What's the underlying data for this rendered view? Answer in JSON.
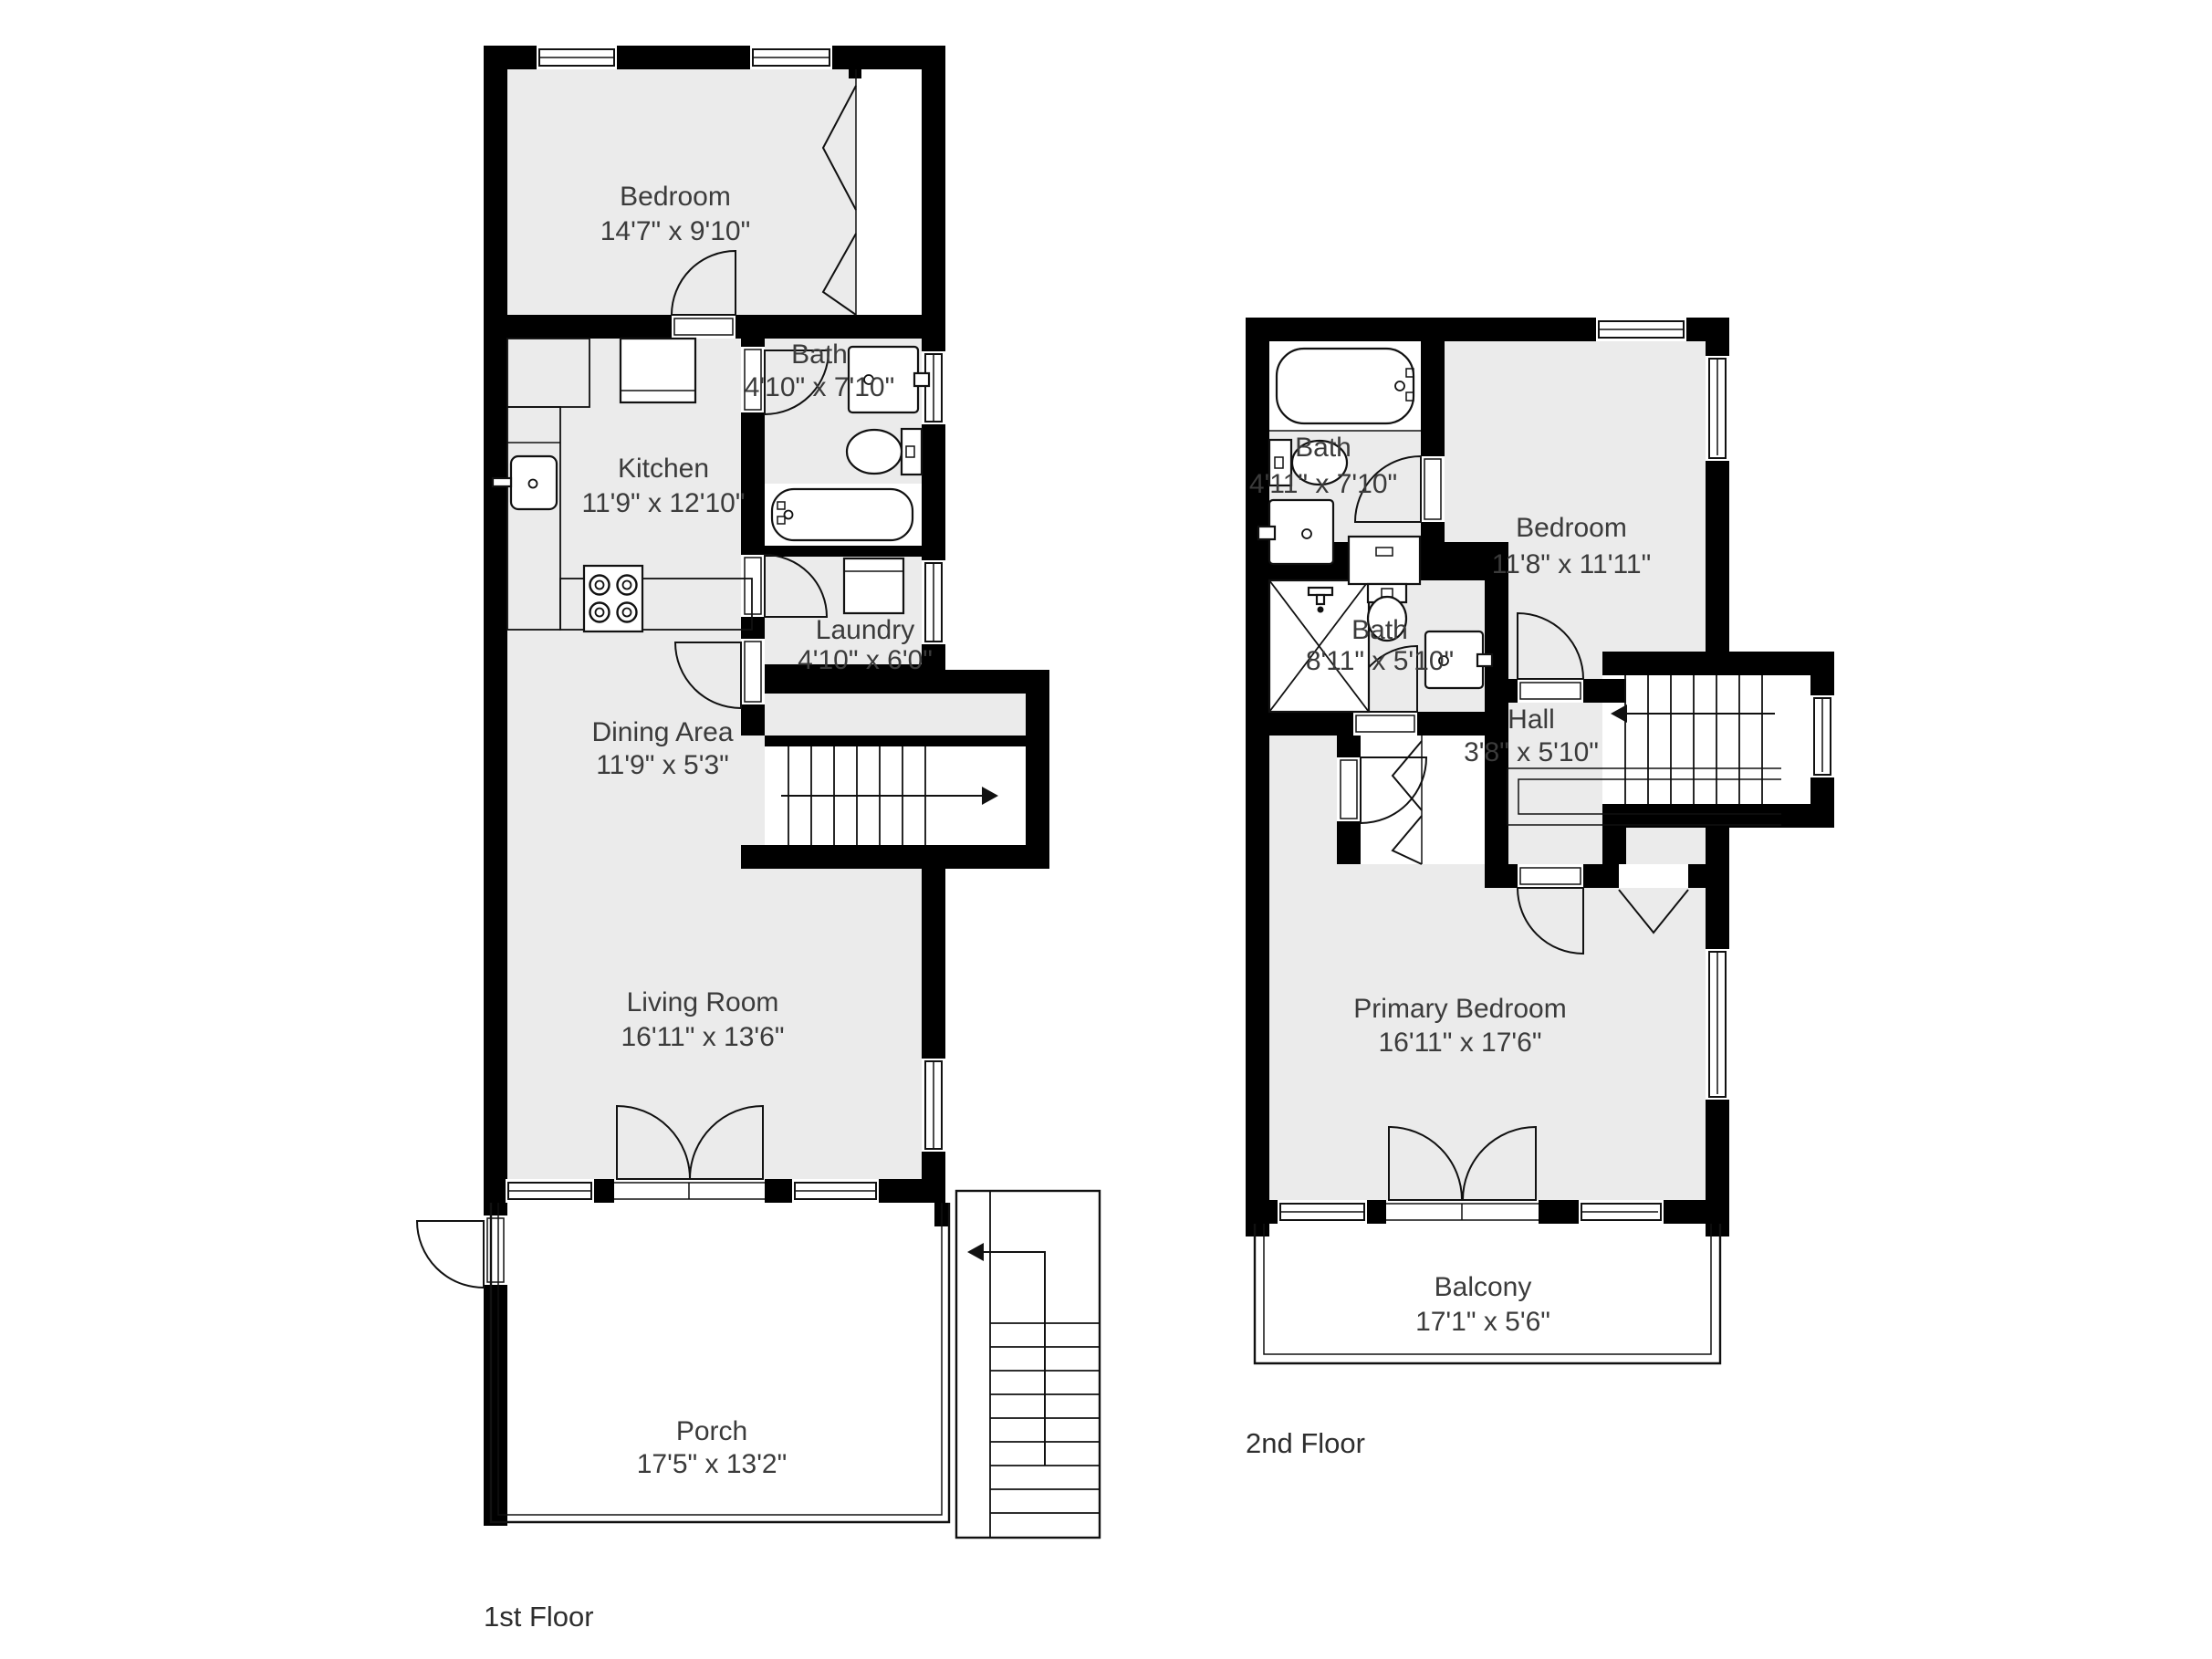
{
  "title": "Two-story floor plan",
  "colors": {
    "wall": "#000000",
    "room_fill": "#ebebeb",
    "label_text": "#3b3b3b",
    "background": "#ffffff"
  },
  "floors": [
    {
      "label": "1st Floor",
      "rooms": [
        {
          "name": "Bedroom",
          "dims": "14'7\" x 9'10\""
        },
        {
          "name": "Bath",
          "dims": "4'10\" x 7'10\""
        },
        {
          "name": "Kitchen",
          "dims": "11'9\" x 12'10\""
        },
        {
          "name": "Laundry",
          "dims": "4'10\" x 6'0\""
        },
        {
          "name": "Dining Area",
          "dims": "11'9\" x 5'3\""
        },
        {
          "name": "Living Room",
          "dims": "16'11\" x 13'6\""
        },
        {
          "name": "Porch",
          "dims": "17'5\" x 13'2\""
        }
      ]
    },
    {
      "label": "2nd Floor",
      "rooms": [
        {
          "name": "Bath",
          "dims": "4'11\" x 7'10\""
        },
        {
          "name": "Bedroom",
          "dims": "11'8\" x 11'11\""
        },
        {
          "name": "Bath",
          "dims": "8'11\" x 5'10\""
        },
        {
          "name": "Hall",
          "dims": "3'8\" x 5'10\""
        },
        {
          "name": "Primary Bedroom",
          "dims": "16'11\" x 17'6\""
        },
        {
          "name": "Balcony",
          "dims": "17'1\" x 5'6\""
        }
      ]
    }
  ]
}
